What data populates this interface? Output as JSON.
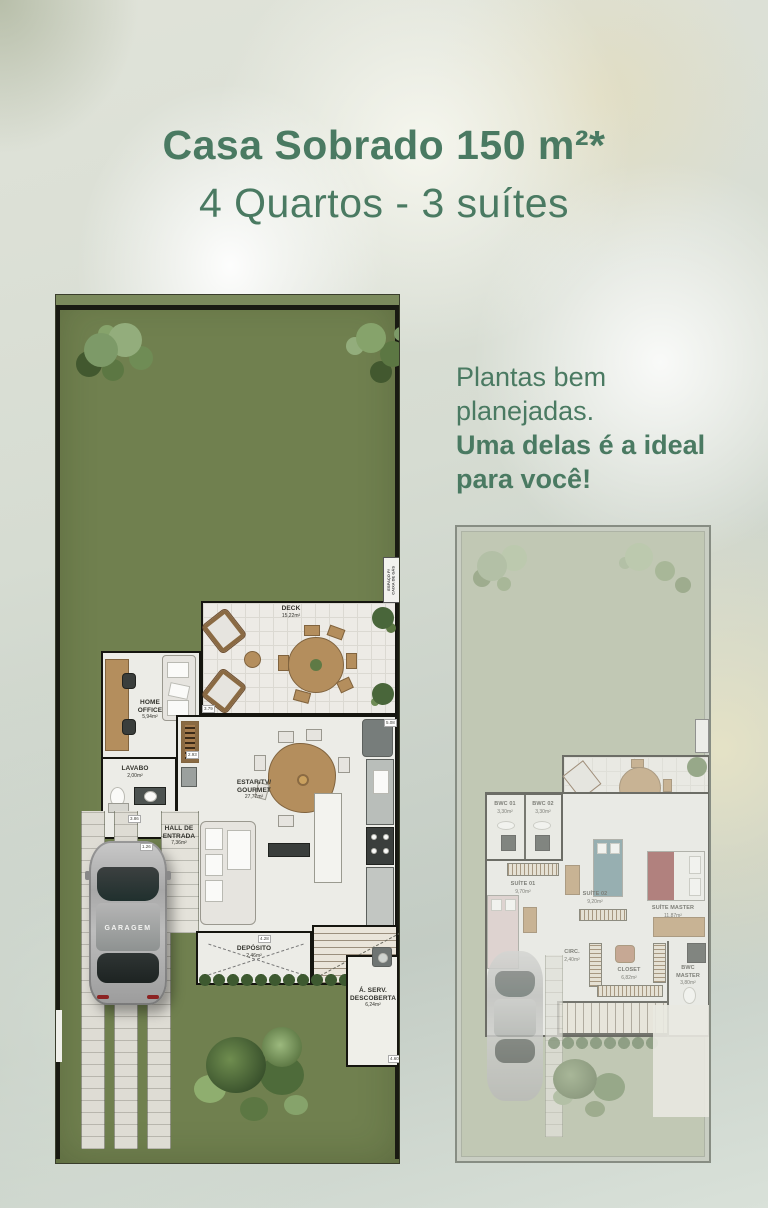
{
  "header": {
    "title_bold": "Casa Sobrado 150 m²*",
    "title_regular": "4 Quartos - 3 suítes"
  },
  "promo": {
    "regular_1": "Plantas bem",
    "regular_2": "planejadas.",
    "bold_1": "Uma delas é a ideal",
    "bold_2": "para você!"
  },
  "colors": {
    "accent_green": "#4a7a62",
    "lawn_green": "#70804f",
    "lawn_faded": "#a7b194"
  },
  "ground_floor": {
    "deck": {
      "label": "DECK",
      "area": "15,22m²"
    },
    "home_office": {
      "label": "HOME\nOFFICE",
      "area": "5,94m²"
    },
    "lavabo": {
      "label": "LAVABO",
      "area": "2,00m²"
    },
    "estar": {
      "label": "ESTAR/TV/\nGOURMET",
      "area": "27,77m²"
    },
    "hall": {
      "label": "HALL DE\nENTRADA",
      "area": "7,36m²"
    },
    "garagem": {
      "label": "GARAGEM"
    },
    "deposito": {
      "label": "DEPÓSITO",
      "area": "2,46m²"
    },
    "area_servico": {
      "label": "Á. SERV.\nDESCOBERTA",
      "area": "6,24m²"
    },
    "gas": {
      "label": "ESPAÇO P/\nCAIXA DE GÁS"
    },
    "dims": [
      "3.79",
      "5.08",
      "2.93",
      "1.26",
      "4.28",
      "3.86",
      "4.60"
    ]
  },
  "upper_floor": {
    "bwc01": {
      "label": "BWC 01",
      "area": "3,30m²"
    },
    "bwc02": {
      "label": "BWC 02",
      "area": "3,30m²"
    },
    "suite01": {
      "label": "SUÍTE 01",
      "area": "9,70m²"
    },
    "suite02": {
      "label": "SUÍTE 02",
      "area": "9,20m²"
    },
    "suite_master": {
      "label": "SUÍTE MASTER",
      "area": "11,87m²"
    },
    "circ": {
      "label": "CIRC.",
      "area": "2,40m²"
    },
    "closet": {
      "label": "CLOSET",
      "area": "6,82m²"
    },
    "bwc_master": {
      "label": "BWC\nMASTER",
      "area": "3,80m²"
    }
  }
}
